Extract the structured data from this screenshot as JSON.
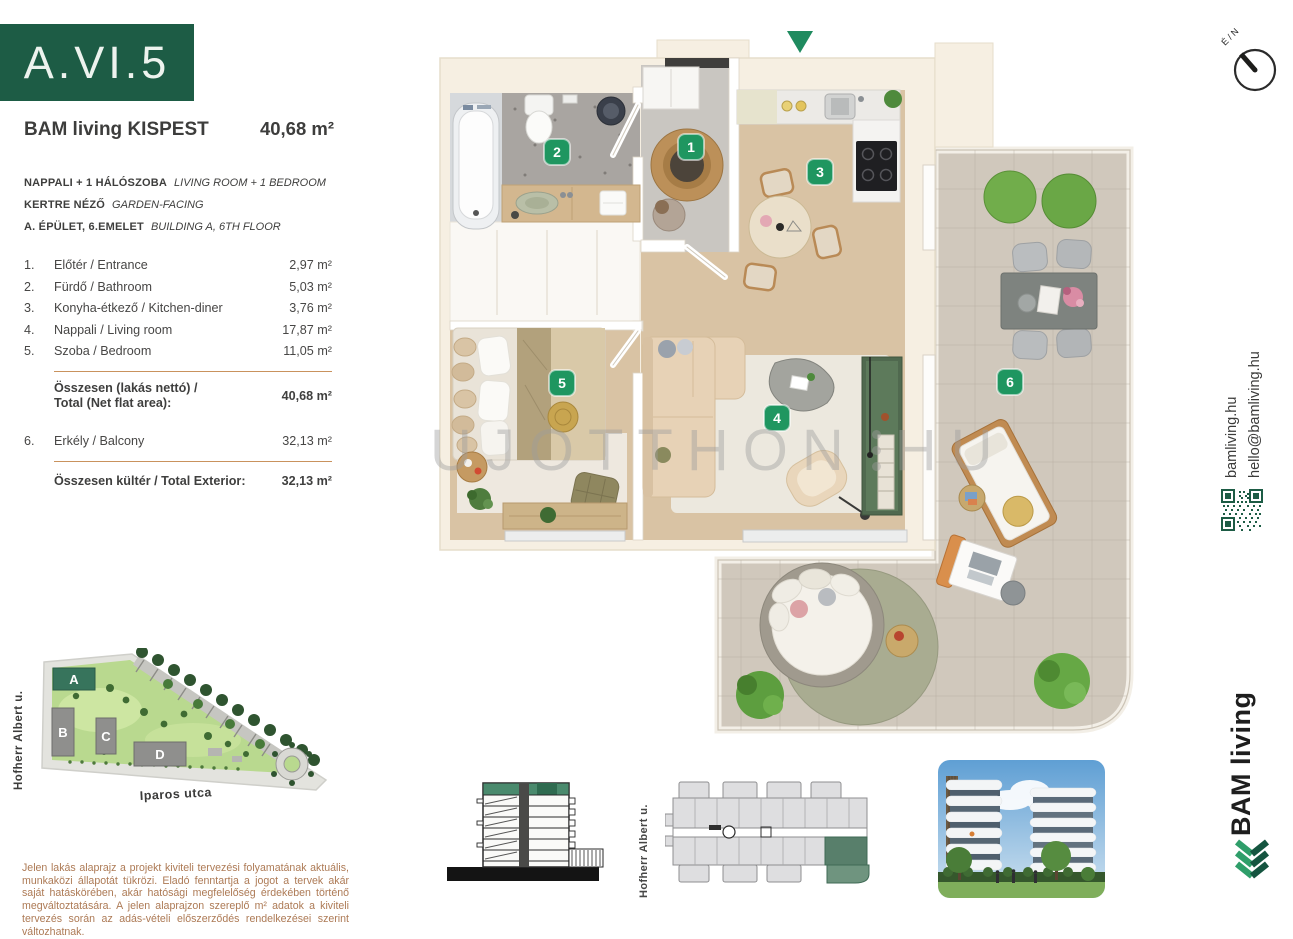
{
  "unit": {
    "code": "A.VI.5"
  },
  "header": {
    "project": "BAM living KISPEST",
    "area": "40,68 m²"
  },
  "subtitle": [
    {
      "hu": "NAPPALI + 1 HÁLÓSZOBA",
      "en": "LIVING ROOM + 1 BEDROOM"
    },
    {
      "hu": "KERTRE NÉZŐ",
      "en": "GARDEN-FACING"
    },
    {
      "hu": "A. ÉPÜLET, 6.EMELET",
      "en": "BUILDING A, 6TH FLOOR"
    }
  ],
  "rooms": [
    {
      "num": "1.",
      "label": "Előtér / Entrance",
      "area": "2,97 m²"
    },
    {
      "num": "2.",
      "label": "Fürdő / Bathroom",
      "area": "5,03 m²"
    },
    {
      "num": "3.",
      "label": "Konyha-étkező / Kitchen-diner",
      "area": "3,76 m²"
    },
    {
      "num": "4.",
      "label": "Nappali / Living room",
      "area": "17,87 m²"
    },
    {
      "num": "5.",
      "label": "Szoba / Bedroom",
      "area": "11,05 m²"
    }
  ],
  "totals": {
    "net_label_1": "Összesen (lakás nettó) /",
    "net_label_2": "Total (Net flat area):",
    "net_value": "40,68 m²",
    "ext_label": "Összesen kültér / Total Exterior:",
    "ext_value": "32,13 m²"
  },
  "exterior": {
    "num": "6.",
    "label": "Erkély / Balcony",
    "area": "32,13 m²"
  },
  "streets": {
    "hofherr": "Hofherr Albert u.",
    "iparos": "Iparos utca"
  },
  "site_map": {
    "buildings": [
      "A",
      "B",
      "C",
      "D"
    ]
  },
  "plan": {
    "markers": {
      "m1": "1",
      "m2": "2",
      "m3": "3",
      "m4": "4",
      "m5": "5",
      "m6": "6"
    },
    "watermark": {
      "left": "UJOTTHON",
      "right": "HU"
    }
  },
  "compass": {
    "label": "É / N"
  },
  "sidebar": {
    "web": "bamliving.hu",
    "email": "hello@bamliving.hu",
    "brand": "BAM living"
  },
  "disclaimer": "Jelen lakás alaprajz a projekt kiviteli tervezési folyamatának aktuális, munkaközi állapotát tükrözi. Eladó fenntartja a jogot a tervek akár saját hatáskörében, akár hatósági megfelelőség érdekében történő megváltoztatására. A jelen alaprajzon szereplő m² adatok a kiviteli tervezés során az adás-vételi előszerződés rendelkezései szerint változhatnak.",
  "colors": {
    "brand_green": "#1d5c45",
    "marker_green": "#1f9660",
    "accent_tan": "#c9925d",
    "disclaimer_text": "#ad7a55",
    "plan_cream": "#f6efe2",
    "wood_floor": "#d9c3a4",
    "balcony_tile": "#d0c8bc"
  }
}
